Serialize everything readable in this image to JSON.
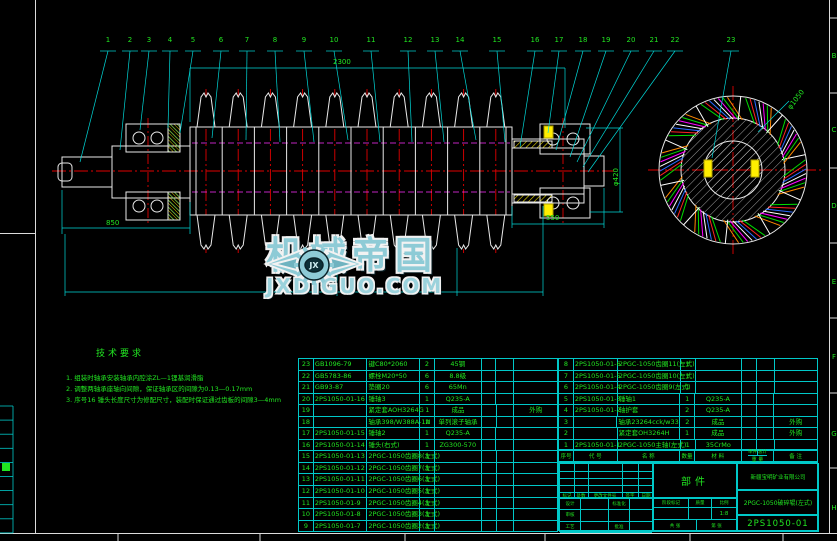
{
  "sheet": {
    "background": "#000000",
    "line_color": "#00c8c8",
    "text_color": "#21e521",
    "centerline_color": "#e00000",
    "hidden_line_color": "#ff30ff",
    "highlight_color": "#ffee00"
  },
  "watermark": {
    "brand": "机械帝国",
    "domain": "JXDIGUO.COM",
    "logo_monogram": "JX"
  },
  "tech_notes": {
    "title": "技术要求",
    "items": [
      "1. 组装时轴承安装轴承内腔涂ZL—1锂基润滑脂",
      "2. 调整两轴承座轴向间隙，保证轴承区的间隙为0.13—0.17mm",
      "3. 序号16 锤头长度尺寸为修配尺寸，装配时保证通过齿板的间隙3—4mm"
    ]
  },
  "balloons": {
    "numbers": [
      "1",
      "2",
      "3",
      "4",
      "5",
      "6",
      "7",
      "8",
      "9",
      "10",
      "11",
      "12",
      "13",
      "14",
      "15",
      "16",
      "17",
      "18",
      "19",
      "20",
      "21",
      "22",
      "23"
    ]
  },
  "dimensions": {
    "overall_top": "2300",
    "left_span": "850",
    "right_span": "550",
    "right_diameter": "φ420",
    "end_view_diameter": "φ1050"
  },
  "zone_letters": [
    "B",
    "C",
    "D",
    "E",
    "F",
    "G",
    "H"
  ],
  "bom": {
    "headers": {
      "no": "序号",
      "code": "代 号",
      "name": "名 称",
      "qty": "数量",
      "material": "材 料",
      "weight": "重 量",
      "weight_unit": "单件",
      "weight_total": "总计",
      "remark": "备 注"
    },
    "left_rows": [
      {
        "no": "23",
        "code": "GB1096-79",
        "name": "键C80*2060",
        "qty": "2",
        "material": "45钢",
        "w1": "",
        "w2": "",
        "remark": ""
      },
      {
        "no": "22",
        "code": "GB5783-86",
        "name": "螺栓M20*50",
        "qty": "6",
        "material": "8.8级",
        "w1": "",
        "w2": "",
        "remark": ""
      },
      {
        "no": "21",
        "code": "GB93-87",
        "name": "垫圈20",
        "qty": "6",
        "material": "65Mn",
        "w1": "",
        "w2": "",
        "remark": ""
      },
      {
        "no": "20",
        "code": "2PS1050-01-16",
        "name": "锤轴3",
        "qty": "1",
        "material": "Q235-A",
        "w1": "",
        "w2": "",
        "remark": ""
      },
      {
        "no": "19",
        "code": "",
        "name": "紧定套AOH3264G",
        "qty": "1",
        "material": "成品",
        "w1": "",
        "w2": "",
        "remark": "外购"
      },
      {
        "no": "18",
        "code": "",
        "name": "轴承398/W388A-1N",
        "qty": "2",
        "material": "单列滚子轴承",
        "w1": "",
        "w2": "",
        "remark": ""
      },
      {
        "no": "17",
        "code": "2PS1050-01-15",
        "name": "锤轴2",
        "qty": "1",
        "material": "Q235-A",
        "w1": "",
        "w2": "",
        "remark": ""
      },
      {
        "no": "16",
        "code": "2PS1050-01-14",
        "name": "锤头(右式)",
        "qty": "1",
        "material": "ZG300-570",
        "w1": "",
        "w2": "",
        "remark": ""
      },
      {
        "no": "15",
        "code": "2PS1050-01-13",
        "name": "2PGC-1050齿圈8(左式)",
        "qty": "1",
        "material": "",
        "w1": "",
        "w2": "",
        "remark": ""
      },
      {
        "no": "14",
        "code": "2PS1050-01-12",
        "name": "2PGC-1050齿圈7(左式)",
        "qty": "1",
        "material": "",
        "w1": "",
        "w2": "",
        "remark": ""
      },
      {
        "no": "13",
        "code": "2PS1050-01-11",
        "name": "2PGC-1050齿圈6(左式)",
        "qty": "1",
        "material": "",
        "w1": "",
        "w2": "",
        "remark": ""
      },
      {
        "no": "12",
        "code": "2PS1050-01-10",
        "name": "2PGC-1050齿圈5(左式)",
        "qty": "1",
        "material": "",
        "w1": "",
        "w2": "",
        "remark": ""
      },
      {
        "no": "11",
        "code": "2PS1050-01-9",
        "name": "2PGC-1050齿圈4(左式)",
        "qty": "1",
        "material": "",
        "w1": "",
        "w2": "",
        "remark": ""
      },
      {
        "no": "10",
        "code": "2PS1050-01-8",
        "name": "2PGC-1050齿圈3(左式)",
        "qty": "1",
        "material": "",
        "w1": "",
        "w2": "",
        "remark": ""
      },
      {
        "no": "9",
        "code": "2PS1050-01-7",
        "name": "2PGC-1050齿圈2(左式)",
        "qty": "1",
        "material": "",
        "w1": "",
        "w2": "",
        "remark": ""
      }
    ],
    "right_rows": [
      {
        "no": "8",
        "code": "2PS1050-01-6",
        "name": "2PGC-1050齿圈11(左式)",
        "qty": "1",
        "material": "",
        "w1": "",
        "w2": "",
        "remark": ""
      },
      {
        "no": "7",
        "code": "2PS1050-01-5",
        "name": "2PGC-1050齿圈10(左式)",
        "qty": "1",
        "material": "",
        "w1": "",
        "w2": "",
        "remark": ""
      },
      {
        "no": "6",
        "code": "2PS1050-01-4",
        "name": "2PGC-1050齿圈9(左式)",
        "qty": "1",
        "material": "",
        "w1": "",
        "w2": "",
        "remark": ""
      },
      {
        "no": "5",
        "code": "2PS1050-01-3",
        "name": "锤轴1",
        "qty": "1",
        "material": "Q235-A",
        "w1": "",
        "w2": "",
        "remark": ""
      },
      {
        "no": "4",
        "code": "2PS1050-01-2",
        "name": "轴护套",
        "qty": "2",
        "material": "Q235-A",
        "w1": "",
        "w2": "",
        "remark": ""
      },
      {
        "no": "3",
        "code": "",
        "name": "轴承23264cck/w33",
        "qty": "2",
        "material": "成品",
        "w1": "",
        "w2": "",
        "remark": "外购"
      },
      {
        "no": "2",
        "code": "",
        "name": "紧定套OH3264H",
        "qty": "1",
        "material": "成品",
        "w1": "",
        "w2": "",
        "remark": "外购"
      },
      {
        "no": "1",
        "code": "2PS1050-01-1",
        "name": "2PGC-1050主轴(左式)",
        "qty": "1",
        "material": "35CrMo",
        "w1": "",
        "w2": "",
        "remark": ""
      }
    ]
  },
  "title_block": {
    "part_label": "部件",
    "company": "新疆宝明矿业有限公司",
    "drawing_title": "2PGC-1050破碎辊(左式)",
    "drawing_no": "2PS1050-01",
    "rev_row": [
      "标记",
      "处数",
      "更改文件号",
      "签字",
      "日期"
    ],
    "sign_rows": [
      [
        "设计",
        "标准化"
      ],
      [
        "审核",
        ""
      ],
      [
        "工艺",
        "批准"
      ]
    ],
    "stage_labels": [
      "阶段标记",
      "质量",
      "比例"
    ],
    "scale": "1:8",
    "sheet_total": "共 张",
    "sheet_no": "第 张"
  }
}
